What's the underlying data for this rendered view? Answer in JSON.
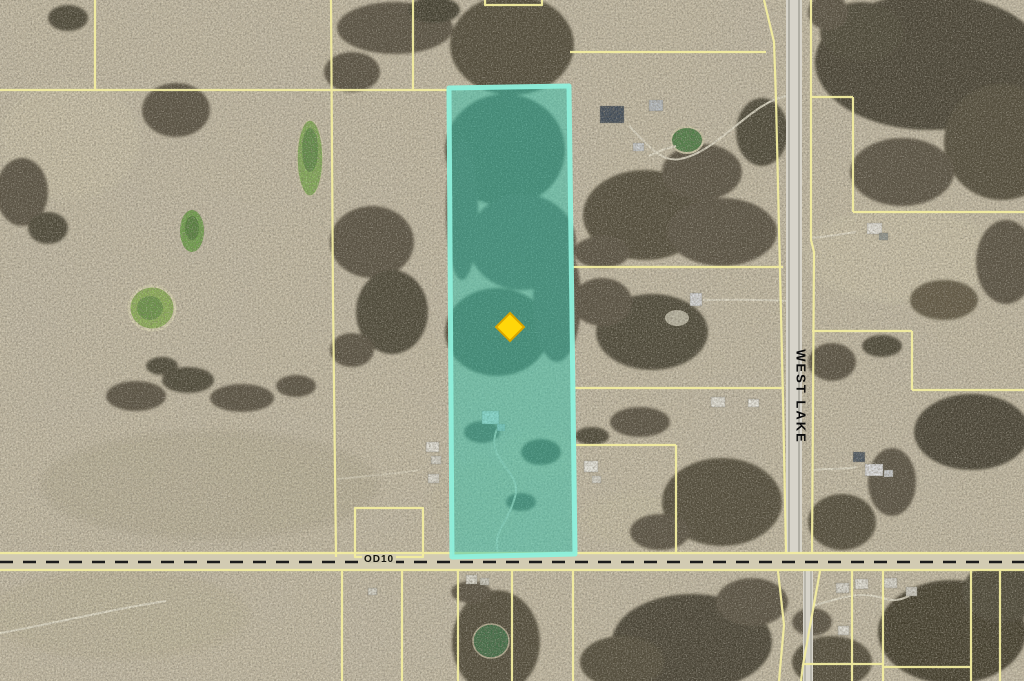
{
  "map": {
    "type": "aerial-parcel-map",
    "roads": [
      {
        "label": "WEST LAKE",
        "orientation": "vertical"
      },
      {
        "label": "OD10",
        "orientation": "horizontal"
      }
    ],
    "highlighted_parcel": {
      "fill_tint": "#35C4AD",
      "border_color": "#8FF0DC"
    },
    "marker": {
      "shape": "diamond",
      "color": "#FFD60A"
    },
    "boundary_line_color": "#F3EDA0"
  }
}
